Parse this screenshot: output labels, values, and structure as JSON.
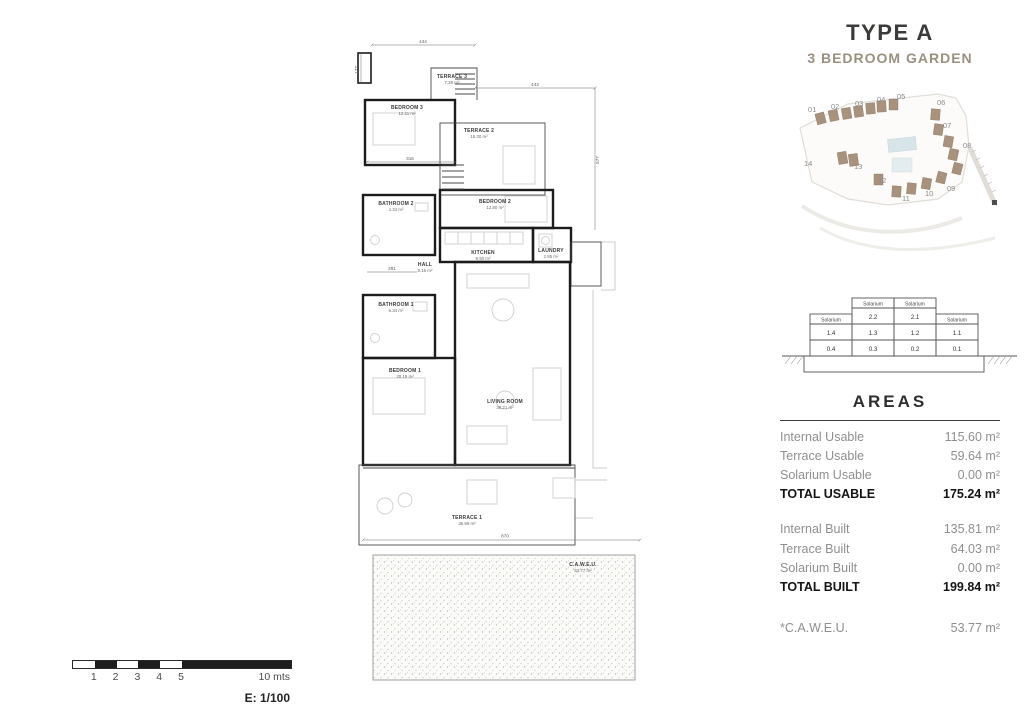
{
  "title": {
    "type": "TYPE A",
    "subtitle": "3 BEDROOM GARDEN"
  },
  "colors": {
    "accent_tan": "#9a9080",
    "building_brown": "#a8917d",
    "wall_black": "#1c1c1c"
  },
  "site_plan": {
    "units": [
      "01",
      "02",
      "03",
      "04",
      "05",
      "06",
      "07",
      "08",
      "09",
      "10",
      "11",
      "12",
      "13",
      "14"
    ]
  },
  "section_table": {
    "solarium_label": "Solarium",
    "upper_values": [
      "2.2",
      "2.1"
    ],
    "first_floor_values": [
      "1.4",
      "1.3",
      "1.2",
      "1.1"
    ],
    "ground_floor_values": [
      "0.4",
      "0.3",
      "0.2",
      "0.1"
    ],
    "highlighted_units": [
      "0.4",
      "0.1"
    ]
  },
  "areas": {
    "heading": "AREAS",
    "usable": [
      {
        "label": "Internal Usable",
        "value": "115.60 m²"
      },
      {
        "label": "Terrace Usable",
        "value": "59.64 m²"
      },
      {
        "label": "Solarium Usable",
        "value": "0.00 m²"
      }
    ],
    "total_usable": {
      "label": "TOTAL USABLE",
      "value": "175.24 m²"
    },
    "built": [
      {
        "label": "Internal Built",
        "value": "135.81 m²"
      },
      {
        "label": "Terrace Built",
        "value": "64.03 m²"
      },
      {
        "label": "Solarium Built",
        "value": "0.00 m²"
      }
    ],
    "total_built": {
      "label": "TOTAL BUILT",
      "value": "199.84 m²"
    },
    "caweu": {
      "label": "*C.A.W.E.U.",
      "value": "53.77 m²"
    }
  },
  "plan": {
    "rooms": [
      {
        "name": "TERRACE 3",
        "area": "7.28 m²"
      },
      {
        "name": "BEDROOM 3",
        "area": "12.11 m²"
      },
      {
        "name": "TERRACE 2",
        "area": "15.30 m²"
      },
      {
        "name": "BATHROOM 2",
        "area": "4.34 m²"
      },
      {
        "name": "BEDROOM 2",
        "area": "12.80 m²"
      },
      {
        "name": "KITCHEN",
        "area": "9.50 m²"
      },
      {
        "name": "LAUNDRY",
        "area": "2.85 m²"
      },
      {
        "name": "HALL",
        "area": "8.16 m²"
      },
      {
        "name": "BATHROOM 1",
        "area": "5.34 m²"
      },
      {
        "name": "BEDROOM 1",
        "area": "20.19 m²"
      },
      {
        "name": "LIVING ROOM",
        "area": "38.21 m²"
      },
      {
        "name": "TERRACE 1",
        "area": "36.99 m²"
      },
      {
        "name": "C.A.W.E.U.",
        "area": "53.77 m²"
      }
    ],
    "dims": [
      "444",
      "177",
      "443",
      "577",
      "316",
      "291",
      "870"
    ]
  },
  "scale_bar": {
    "ticks": [
      "1",
      "2",
      "3",
      "4",
      "5"
    ],
    "end_label": "10 mts",
    "scale_label": "E: 1/100"
  }
}
